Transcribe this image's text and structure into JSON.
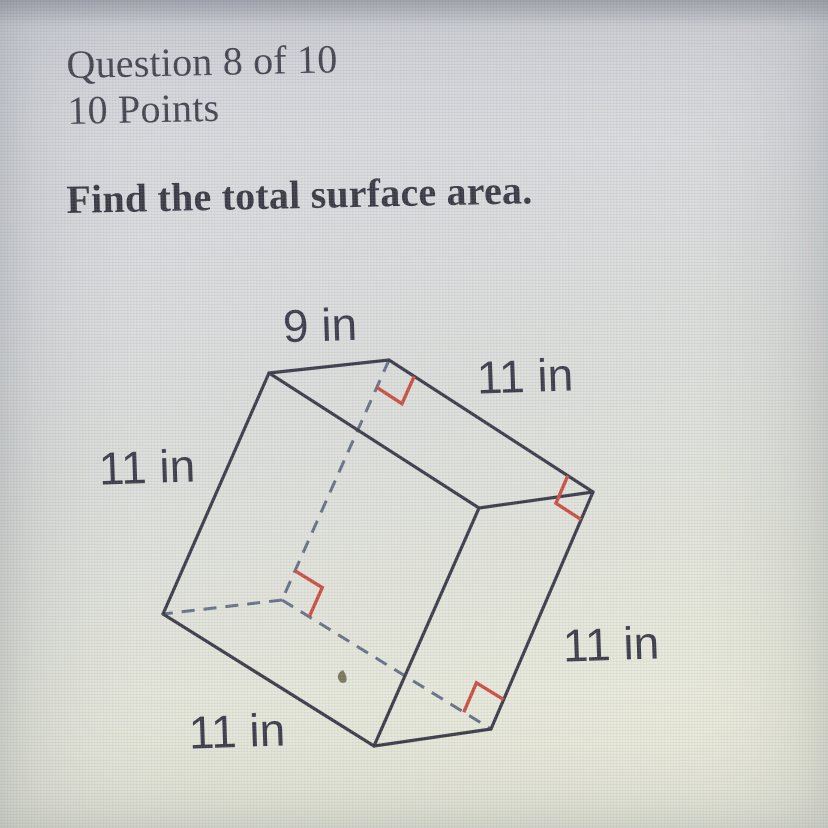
{
  "header": {
    "question_progress": "Question 8 of 10",
    "points_label": "10 Points"
  },
  "prompt": "Find the total surface area.",
  "colors": {
    "background_top": "#d2d4da",
    "background_bottom": "#eceddc",
    "solid_edge": "#30303f",
    "hidden_edge": "#5f6980",
    "right_angle_mark": "#c74638",
    "label_text": "#303040",
    "heading_text": "#3b3b47"
  },
  "diagram": {
    "unit": "in",
    "shape": "rectangular-prism",
    "dimension_labels": [
      {
        "name": "dim-label-top-9in",
        "text": "9 in",
        "x": 320,
        "y": 325
      },
      {
        "name": "dim-label-topright-11in",
        "text": "11 in",
        "x": 525,
        "y": 376
      },
      {
        "name": "dim-label-left-11in",
        "text": "11 in",
        "x": 147,
        "y": 467
      },
      {
        "name": "dim-label-right-11in",
        "text": "11 in",
        "x": 611,
        "y": 644
      },
      {
        "name": "dim-label-bottom-11in",
        "text": "11 in",
        "x": 237,
        "y": 731
      }
    ],
    "vertices": {
      "A": [
        269,
        373
      ],
      "B": [
        389,
        360
      ],
      "C": [
        593,
        492
      ],
      "D": [
        479,
        508
      ],
      "E": [
        163,
        614
      ],
      "F": [
        282,
        600
      ],
      "G": [
        374,
        746
      ],
      "H": [
        491,
        729
      ]
    },
    "solid_edges": [
      [
        "A",
        "B"
      ],
      [
        "B",
        "C"
      ],
      [
        "C",
        "D"
      ],
      [
        "D",
        "A"
      ],
      [
        "A",
        "E"
      ],
      [
        "D",
        "G"
      ],
      [
        "C",
        "H"
      ],
      [
        "E",
        "G"
      ],
      [
        "G",
        "H"
      ]
    ],
    "dashed_edges": [
      [
        "B",
        "F"
      ],
      [
        "F",
        "E"
      ],
      [
        "F",
        "H"
      ]
    ],
    "right_angle_marks": [
      {
        "vertex": "B",
        "toward": [
          "F",
          "C"
        ],
        "size": 30
      },
      {
        "vertex": "C",
        "toward": [
          "B",
          "H"
        ],
        "size": 30
      },
      {
        "vertex": "F",
        "toward": [
          "B",
          "H"
        ],
        "size": 32
      },
      {
        "vertex": "H",
        "toward": [
          "F",
          "C"
        ],
        "size": 32
      }
    ],
    "speck": {
      "x": 343,
      "y": 677,
      "color": "#5f5a38"
    },
    "style": {
      "solid_width": 3.2,
      "dashed_width": 3,
      "dash_pattern": "13 9",
      "mark_width": 3.4,
      "label_font_size": 46,
      "label_rotation_deg": -2
    }
  }
}
